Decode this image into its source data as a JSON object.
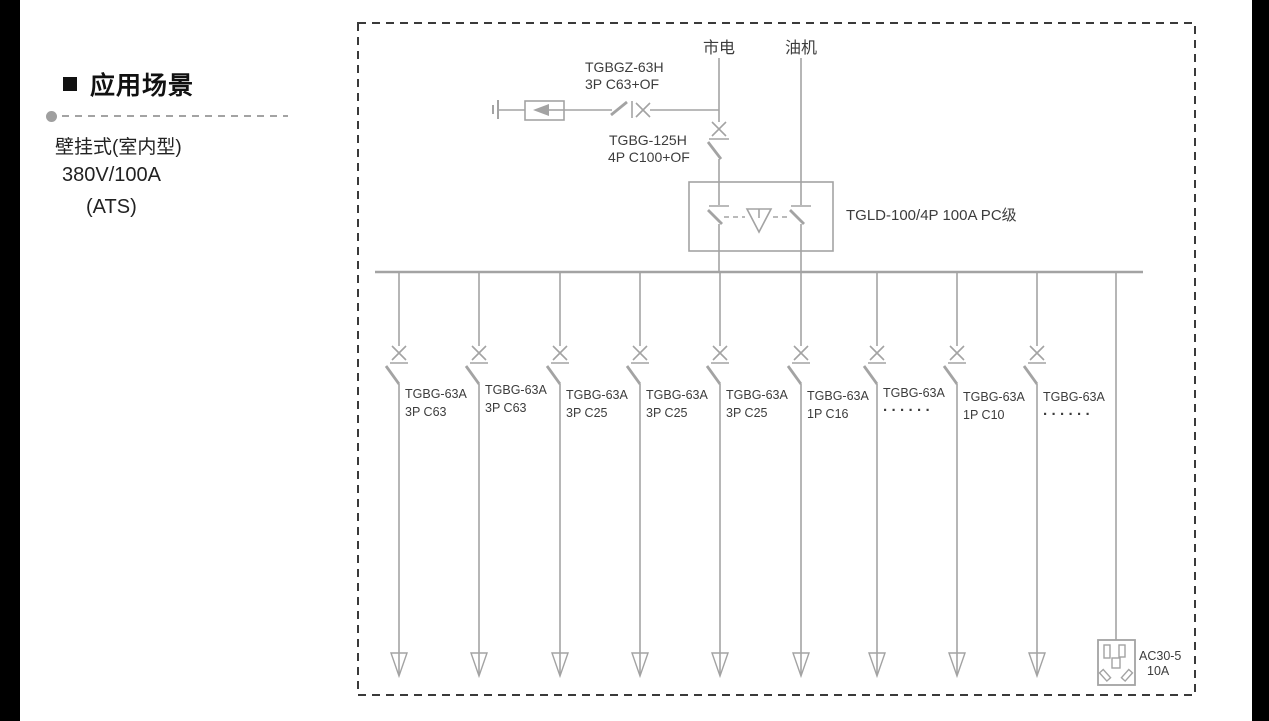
{
  "sidebar": {
    "title": "应用场景",
    "line1": "壁挂式(室内型)",
    "line2": "380V/100A",
    "line3": "(ATS)"
  },
  "diagram": {
    "colors": {
      "line": "#a3a3a3",
      "text": "#3c3c3c",
      "border": "#3a3a3a"
    },
    "sources": {
      "mains": "市电",
      "generator": "油机"
    },
    "spd": {
      "model": "TGBGZ-63H",
      "spec": "3P C63+OF"
    },
    "main_breaker": {
      "model": "TGBG-125H",
      "spec": "4P C100+OF"
    },
    "ats": {
      "label": "TGLD-100/4P 100A PC级"
    },
    "branches": [
      {
        "model": "TGBG-63A",
        "spec": "3P C63"
      },
      {
        "model": "TGBG-63A",
        "spec": "3P C63"
      },
      {
        "model": "TGBG-63A",
        "spec": "3P C25"
      },
      {
        "model": "TGBG-63A",
        "spec": "3P C25"
      },
      {
        "model": "TGBG-63A",
        "spec": "3P C25"
      },
      {
        "model": "TGBG-63A",
        "spec": "1P C16"
      },
      {
        "model": "TGBG-63A",
        "spec": "······"
      },
      {
        "model": "TGBG-63A",
        "spec": "1P C10"
      },
      {
        "model": "TGBG-63A",
        "spec": "······"
      }
    ],
    "socket": {
      "model": "AC30-5",
      "rating": "10A"
    }
  }
}
